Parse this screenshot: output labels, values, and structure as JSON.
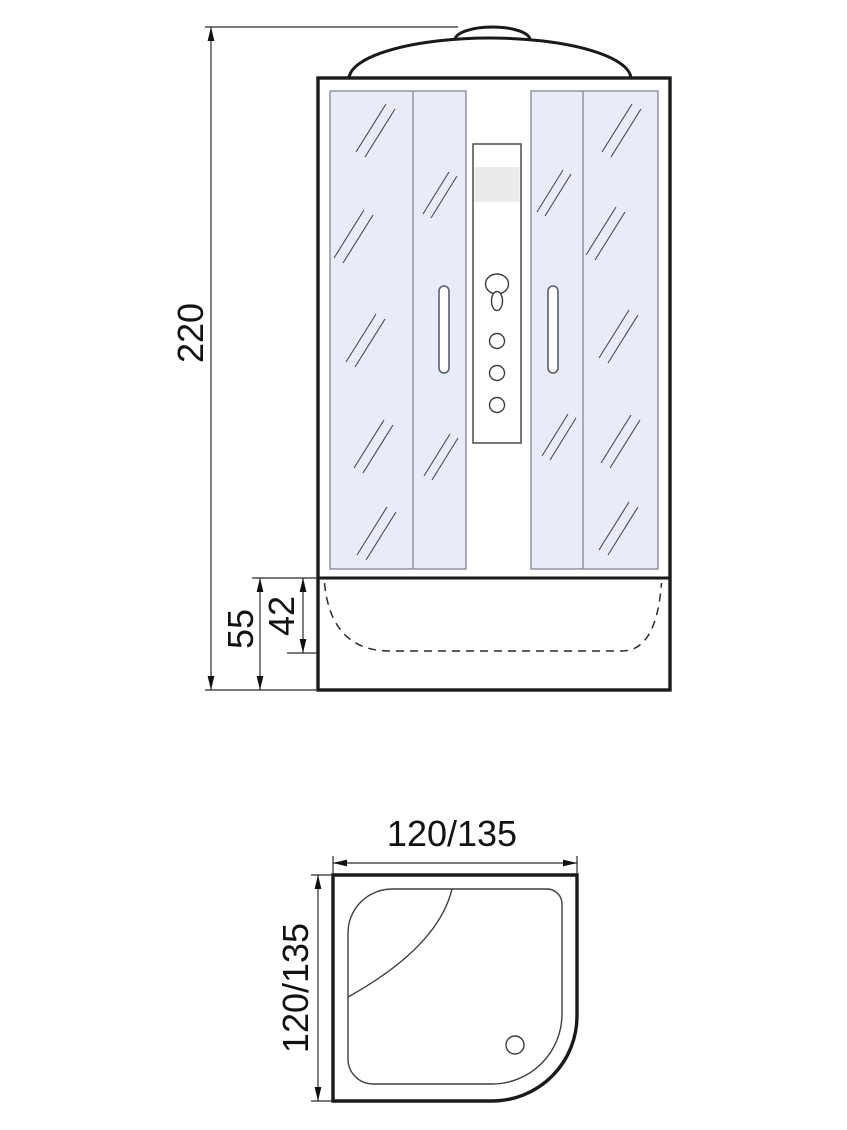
{
  "front_view": {
    "overall_height_label": "220",
    "tray_height_label": "55",
    "tray_inner_depth_label": "42"
  },
  "plan_view": {
    "width_label": "120/135",
    "depth_label": "120/135"
  },
  "icons": {
    "shower_head": "shower-head-icon",
    "control_knobs": "control-knob-icon",
    "drain": "drain-icon"
  },
  "colors": {
    "outline": "#1a1a1a",
    "thin_line": "#3d3d3d",
    "dim_line": "#2b2b2b",
    "glass_fill": "#e8ecf8",
    "glass_stroke": "#8a8f9b",
    "band_fill": "#ebebeb",
    "text_color": "#121212",
    "background": "#ffffff"
  }
}
